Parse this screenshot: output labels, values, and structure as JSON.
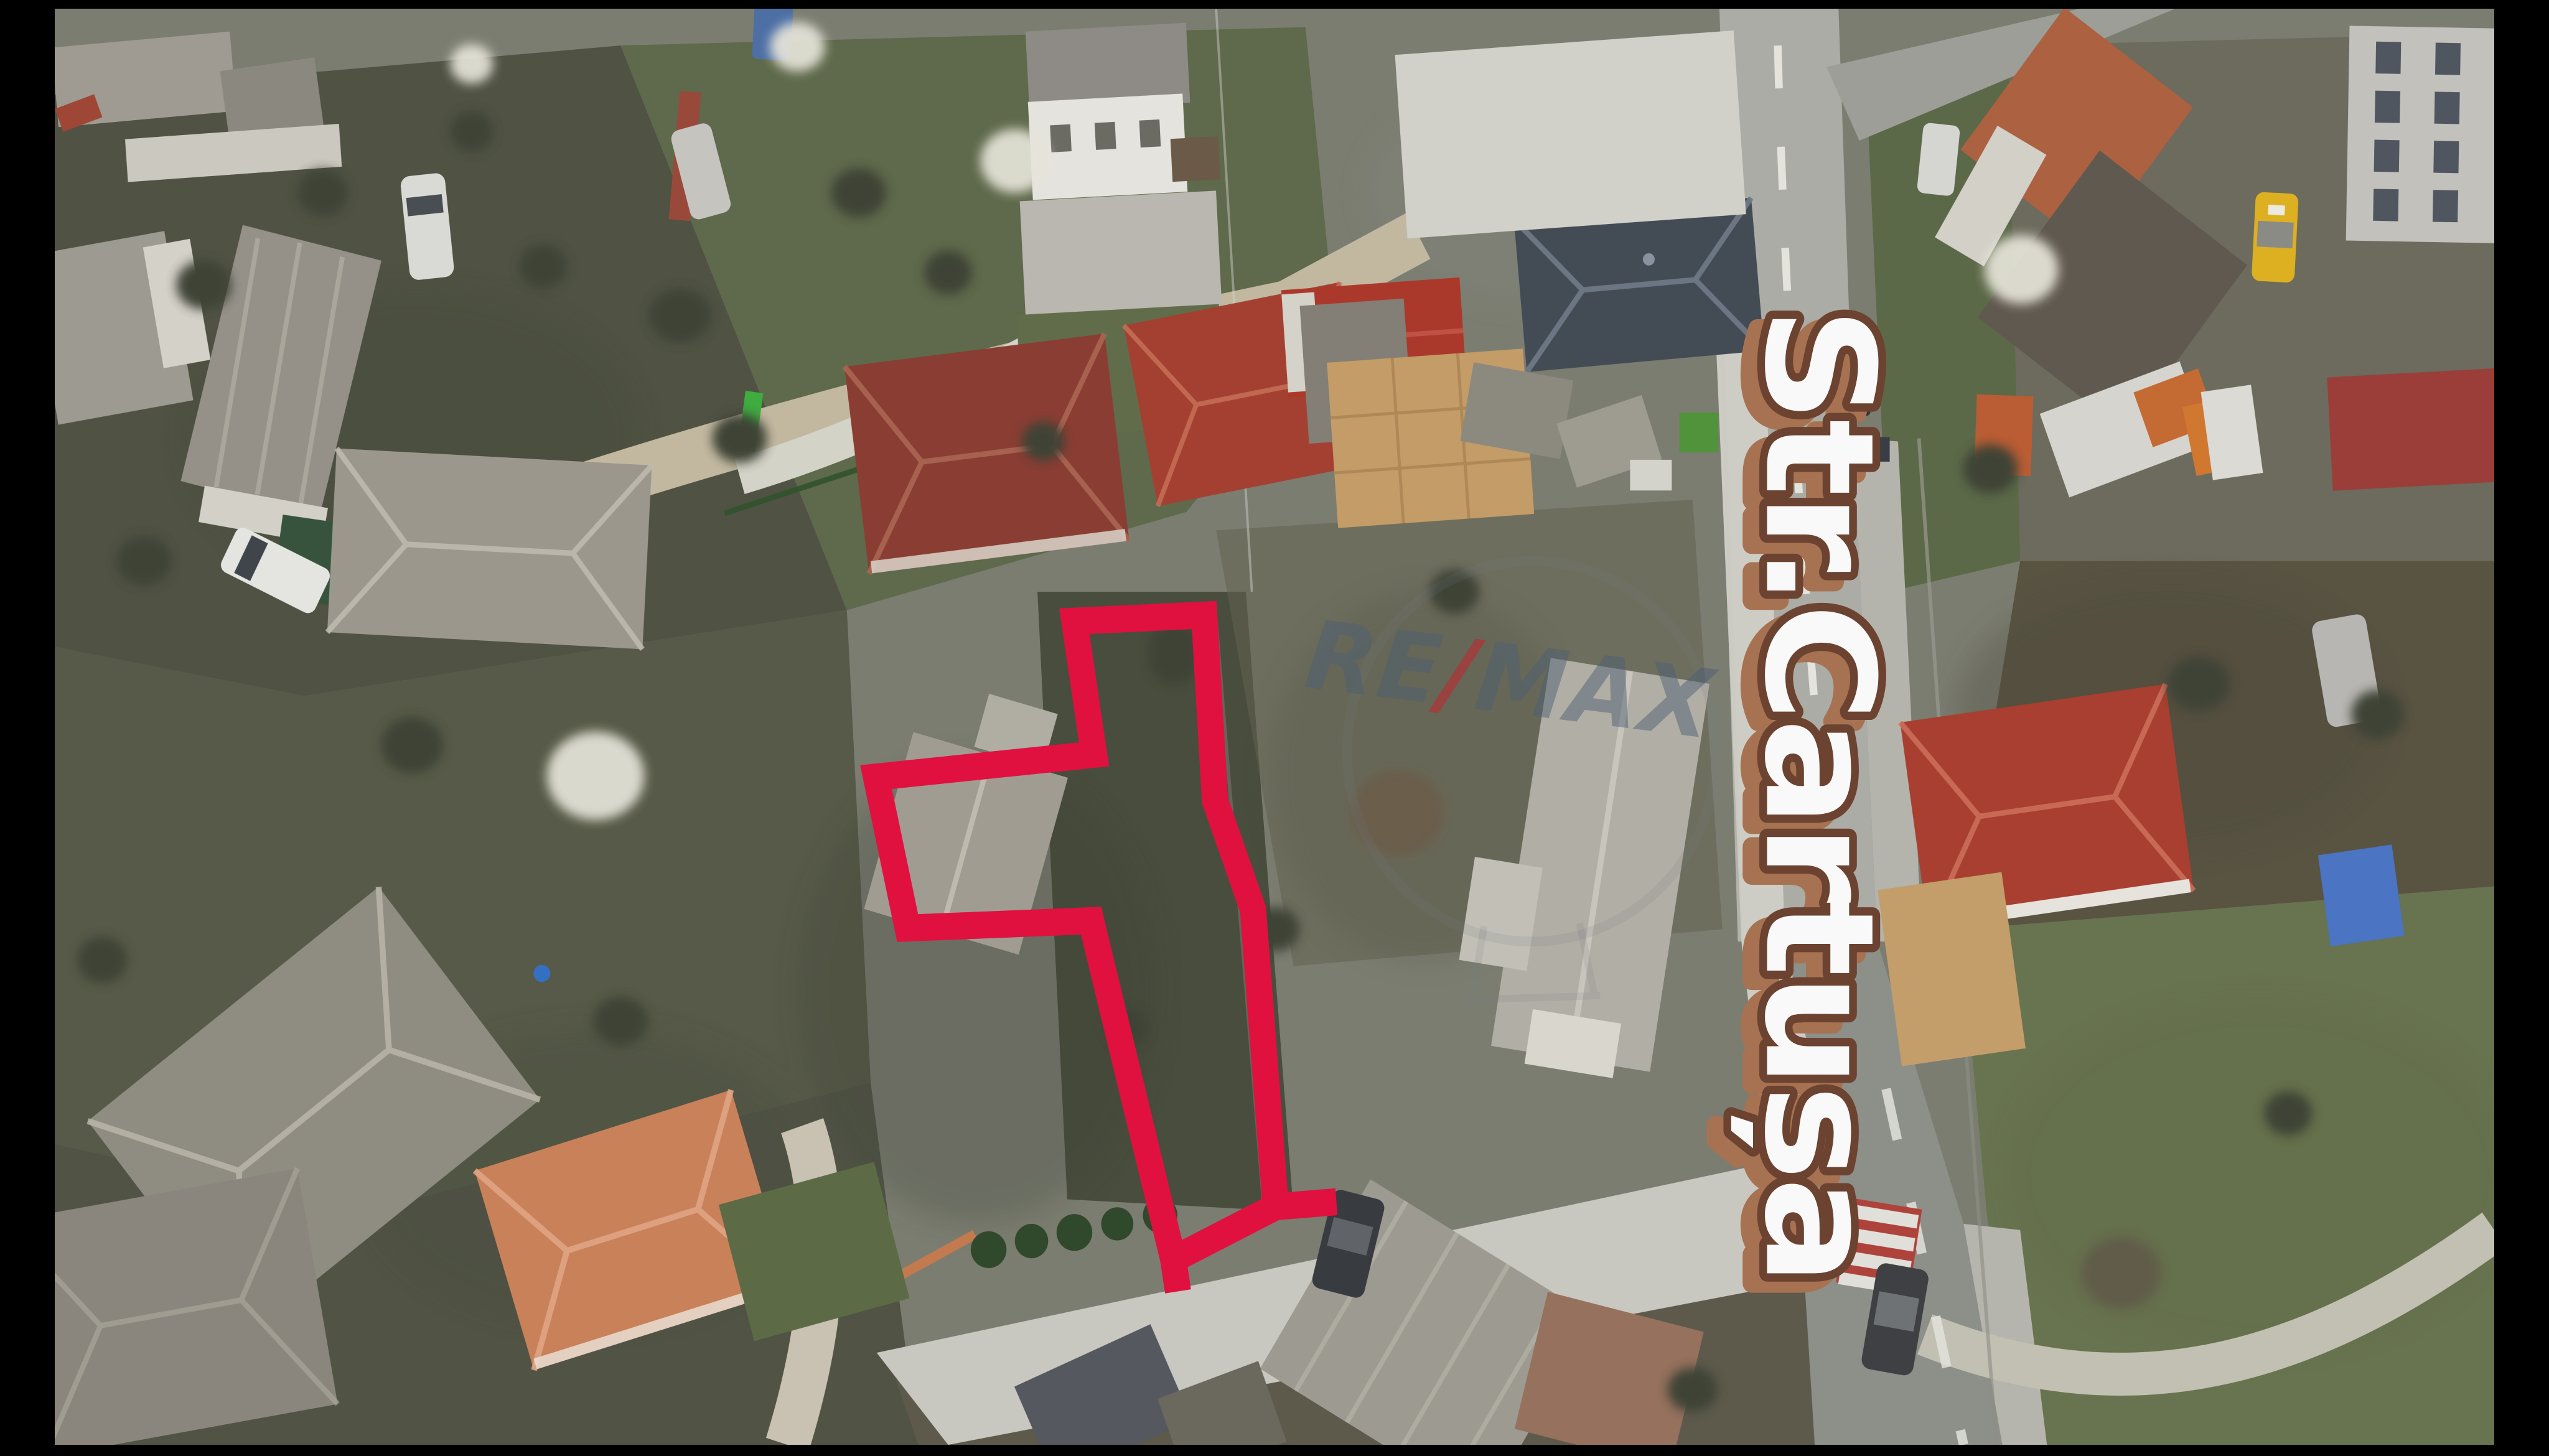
{
  "frame": {
    "kind": "drone aerial photo of residential street with property outline",
    "letterbox": true
  },
  "overlay": {
    "street_label": "Str.Cartușa",
    "watermark": {
      "re": "RE",
      "slash": "/",
      "max": "MAX"
    }
  },
  "colors": {
    "outline_red": "#e50b3c",
    "label_fill": "#ffffff",
    "label_outline": "#6b3f2c",
    "label_shadow": "#a9714e",
    "watermark_gray": "rgba(72,92,112,0.48)",
    "watermark_red": "rgba(196,30,40,0.55)",
    "letterbox": "#000000",
    "road_light": "#adaea7",
    "road_dark": "#8e908a",
    "salmon_roof": "#cd8158",
    "maroon_roof": "#8b3a2f",
    "navy_roof": "#404853"
  }
}
